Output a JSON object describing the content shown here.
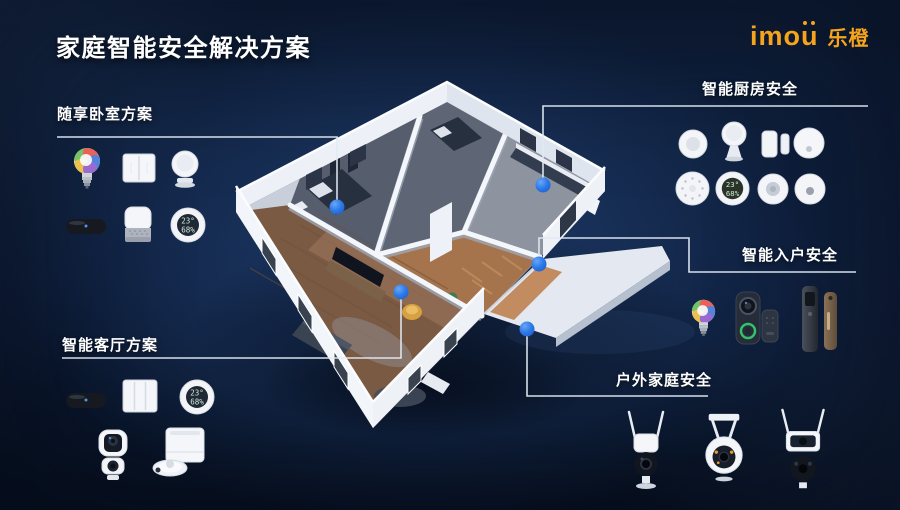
{
  "slide": {
    "title": "家庭智能安全解决方案"
  },
  "logo": {
    "brand": "imou",
    "brand_cn": "乐橙",
    "color": "#F6A41C"
  },
  "sections": {
    "bedroom": {
      "label": "随享卧室方案",
      "items": [
        "smart-bulb",
        "wall-switch-2gang",
        "indoor-pt-camera",
        "sleep-monitor",
        "aroma-night-light",
        "temp-humidity-sensor"
      ]
    },
    "kitchen": {
      "label": "智能厨房安全",
      "items": [
        "wireless-button",
        "pir-motion-sensor",
        "door-window-sensor",
        "smart-gateway",
        "smoke-detector",
        "temp-humidity-display",
        "gas-detector",
        "water-leak-sensor"
      ]
    },
    "entry": {
      "label": "智能入户安全",
      "items": [
        "smart-bulb",
        "video-doorbell",
        "doorbell-chime",
        "smart-door-lock"
      ]
    },
    "living": {
      "label": "智能客厅方案",
      "items": [
        "sleep-monitor",
        "wall-switch-3gang",
        "temp-humidity-display",
        "dual-lens-pt-camera",
        "robot-vacuum"
      ]
    },
    "outdoor": {
      "label": "户外家庭安全",
      "items": [
        "outdoor-ptz-camera",
        "outdoor-dome-camera",
        "dual-lens-outdoor-camera"
      ]
    }
  },
  "sensor_display": {
    "temp": "23°",
    "humidity": "68%"
  },
  "markers": [
    "bedroom",
    "kitchen",
    "entry",
    "living-room",
    "outdoor"
  ],
  "colors": {
    "background": "#0D1C38",
    "accent_blue": "#2D7BE8",
    "connector": "#E2EAF4",
    "brand_orange": "#F6A41C",
    "text": "#FFFFFF"
  }
}
